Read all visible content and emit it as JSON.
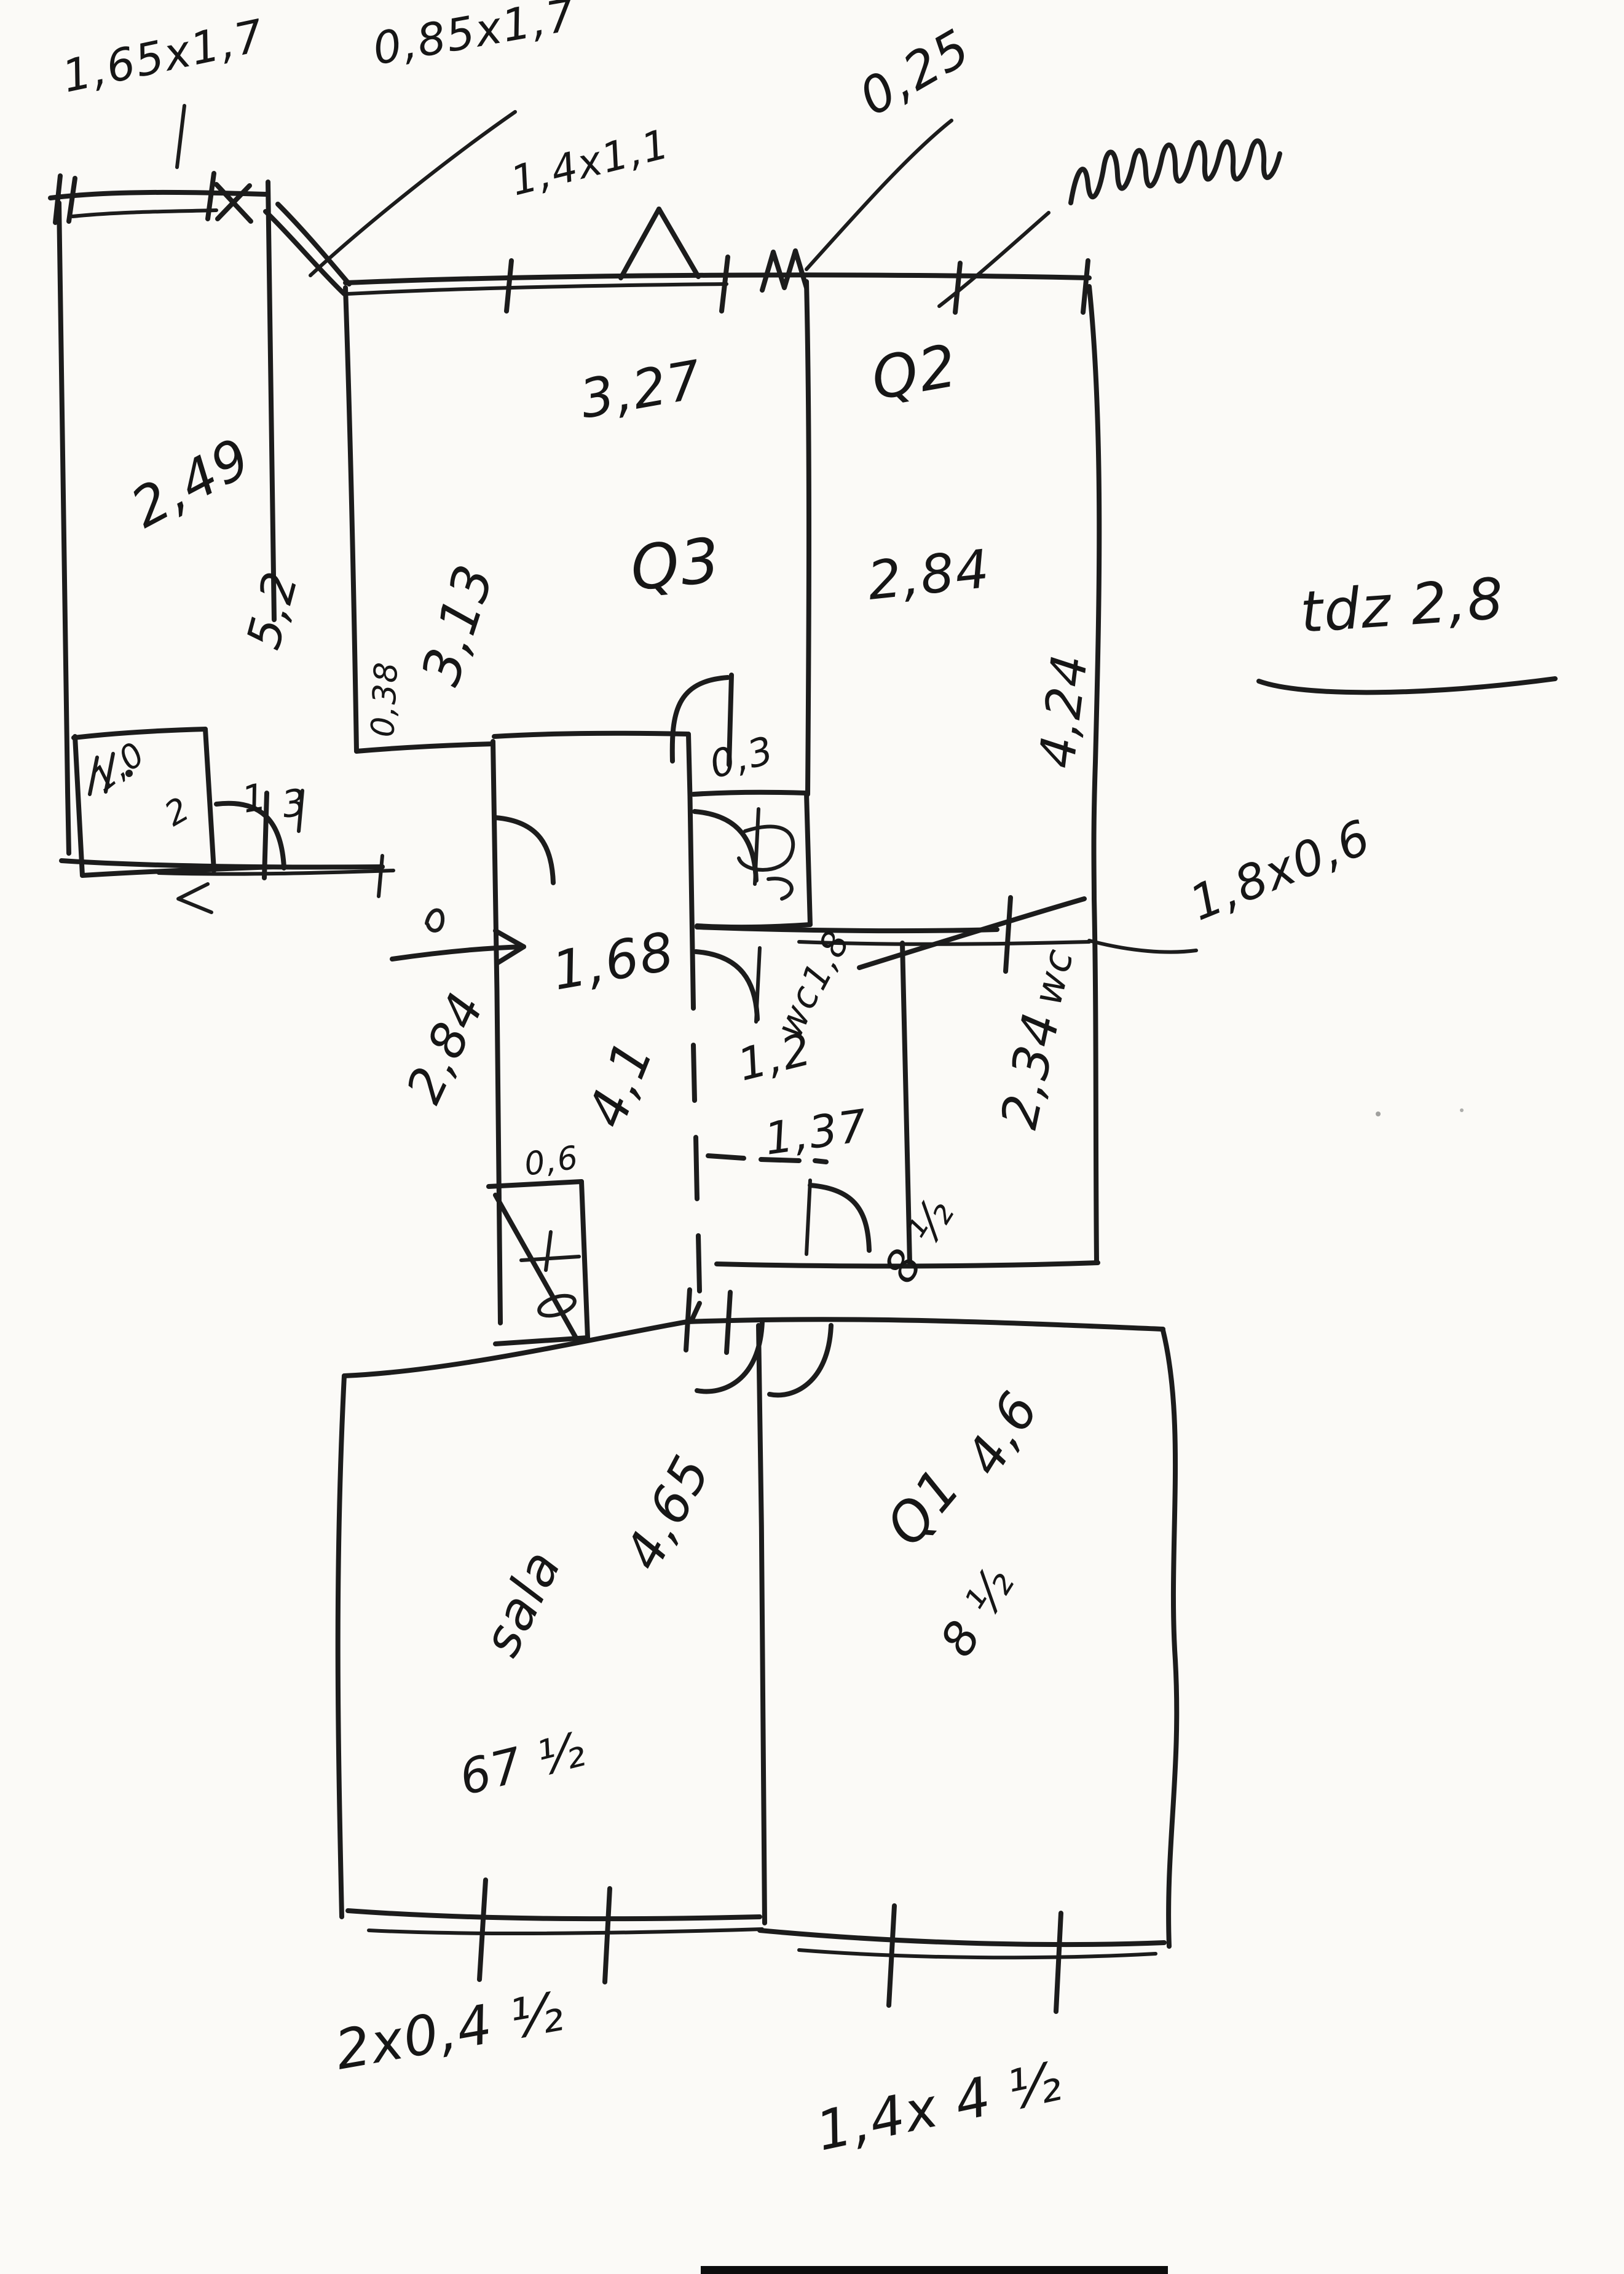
{
  "document": {
    "kind": "hand-drawn floor plan sketch",
    "medium": "black ink on white scanned paper"
  },
  "colors": {
    "ink": "#1c1c1c",
    "paper": "#fbfaf7"
  },
  "labels": {
    "win_165x17": "1,65x1,7",
    "win_085x17": "0,85x1,7",
    "win_14x11": "1,4x1,1",
    "dim_025": "0,25",
    "room1_249": "2,49",
    "room1_52": "5,2",
    "closet_10": "1,0",
    "closet_2": "2",
    "q3_327": "3,27",
    "q3_name": "Q3",
    "q3_313": "3,13",
    "q2_name": "Q2",
    "q2_284": "2,84",
    "q2_424": "4,24",
    "note_tdz": "tdz 2,8",
    "hall_03": "0,3",
    "hall_038": "0,38",
    "mark_1": "1",
    "mark_3": "3",
    "hall_168": "1,68",
    "hall_41": "4,1",
    "hall_284": "2,84",
    "cup_06": "0,6",
    "wc1_18": "1,8",
    "wc1_wc": "wc",
    "wc1_12": "1,2",
    "wc1_137": "1,37",
    "wc2_wc": "wc",
    "wc2_234": "2,34",
    "mid_85": "8 ½",
    "dim_18x06": "1,8x0,6",
    "sala_name": "sala",
    "sala_465": "4,65",
    "sala_675": "67 ½",
    "q1_46": "4,6",
    "q1_name": "Q1",
    "q1_85": "8 ½",
    "win_2x045": "2x0,4 ½",
    "win_14x45": "1,4x 4 ½"
  },
  "scribbles": {
    "top_right_word": "illegible handwritten word"
  }
}
